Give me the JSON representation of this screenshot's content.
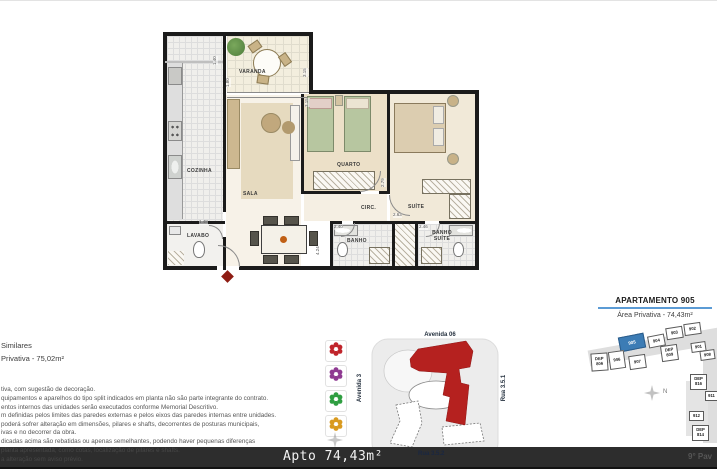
{
  "floor_plan": {
    "room_labels": {
      "varanda": "VARANDA",
      "cozinha": "COZINHA",
      "sala": "SALA",
      "lavabo": "LAVABO",
      "quarto": "QUARTO",
      "circ": "CIRC.",
      "suite": "SUÍTE",
      "banho": "BANHO",
      "banho_suite": "BANHO SUÍTE"
    },
    "dimensions": {
      "varanda_left": "1.40",
      "varanda_left_lower": "1.80",
      "varanda_right": "3.15",
      "quarto_left": "3.15",
      "quarto_right": "2.79",
      "suite_circ": "2.63",
      "banho": "2.40",
      "banho_suite": "2.46",
      "lavabo": "1.48",
      "sala_right": "4.24"
    }
  },
  "left_text": {
    "fragment_line1": "Similares",
    "fragment_line2": "Privativa - 75,02m²",
    "disclaimer": [
      "tiva, com sugestão de decoração.",
      "quipamentos e aparelhos do tipo split indicados em planta não são parte integrante do contrato.",
      "entos internos das unidades serão executados conforme Memorial Descritivo.",
      "m definidas pelos limites das paredes externas e pelos eixos das paredes internas entre unidades.",
      "poderá sofrer alteração em dimensões, pilares e shafts, decorrentes de posturas  municipais,",
      "ivas e no decorrer da obra.",
      "dicadas acima são rebatidas ou apenas semelhantes, podendo haver pequenas diferenças",
      "planta apresentada, como cotas, localização de pilares e shafts.",
      "a alteração sem aviso prévio."
    ]
  },
  "legend": {
    "items": [
      {
        "name": "flower-red",
        "color": "#c0242b"
      },
      {
        "name": "flower-purple",
        "color": "#8f3a92"
      },
      {
        "name": "flower-green",
        "color": "#2f9e41"
      },
      {
        "name": "flower-orange",
        "color": "#d99a1f"
      }
    ]
  },
  "site_plan": {
    "street_top": "Avenida 06",
    "street_left": "Avenida 3",
    "street_right": "Rua 3.5.1",
    "highlight_color": "#b5211f"
  },
  "key_plan": {
    "title": "APARTAMENTO 905",
    "subtitle": "Área Privativa - 74,43m²",
    "compass": "N",
    "highlight_color": "#3c7cb5",
    "units": [
      "905",
      "904",
      "903",
      "902",
      "901",
      "908",
      "906",
      "907",
      "DEP 806",
      "DEP 809",
      "DEP 816",
      "911",
      "912",
      "DEP 814"
    ]
  },
  "bottom_bar": {
    "label": "Apto 74,43m²",
    "street_label": "Rua 3.5.2",
    "floor_label": "9° Pav"
  }
}
